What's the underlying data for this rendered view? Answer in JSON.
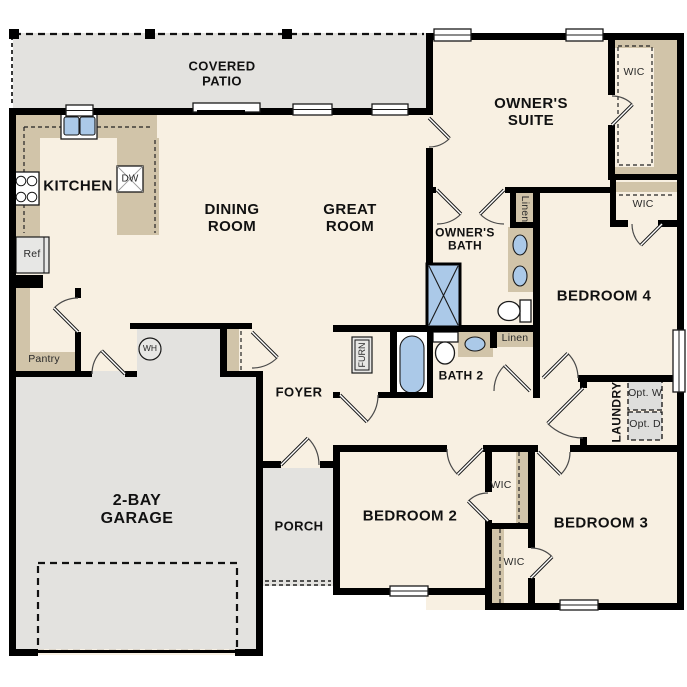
{
  "colors": {
    "wall": "#000000",
    "floor": "#f8f0e2",
    "patio_gray": "#e3e2df",
    "casework_tan": "#d1c4a9",
    "fixture_gray": "#e7e7e5",
    "water_blue": "#abc9e8"
  },
  "rooms": {
    "covered_patio": "COVERED PATIO",
    "kitchen": "KITCHEN",
    "dining_room": "DINING ROOM",
    "great_room": "GREAT ROOM",
    "owners_suite": "OWNER'S SUITE",
    "owners_bath": "OWNER'S BATH",
    "bath_2": "BATH 2",
    "bedroom_2": "BEDROOM 2",
    "bedroom_3": "BEDROOM 3",
    "bedroom_4": "BEDROOM 4",
    "garage": "2-BAY GARAGE",
    "foyer": "FOYER",
    "porch": "PORCH",
    "laundry": "LAUNDRY"
  },
  "closets": {
    "wic_owner": "WIC",
    "wic_bedroom4": "WIC",
    "wic_bedroom2": "WIC",
    "wic_bedroom3": "WIC",
    "linen_hall": "Linen",
    "linen_bath2": "Linen",
    "pantry": "Pantry"
  },
  "fixtures": {
    "refrigerator": "Ref",
    "dishwasher": "DW",
    "water_heater": "WH",
    "furnace": "FURN",
    "optional_washer": "Opt. W",
    "optional_dryer": "Opt. D"
  }
}
